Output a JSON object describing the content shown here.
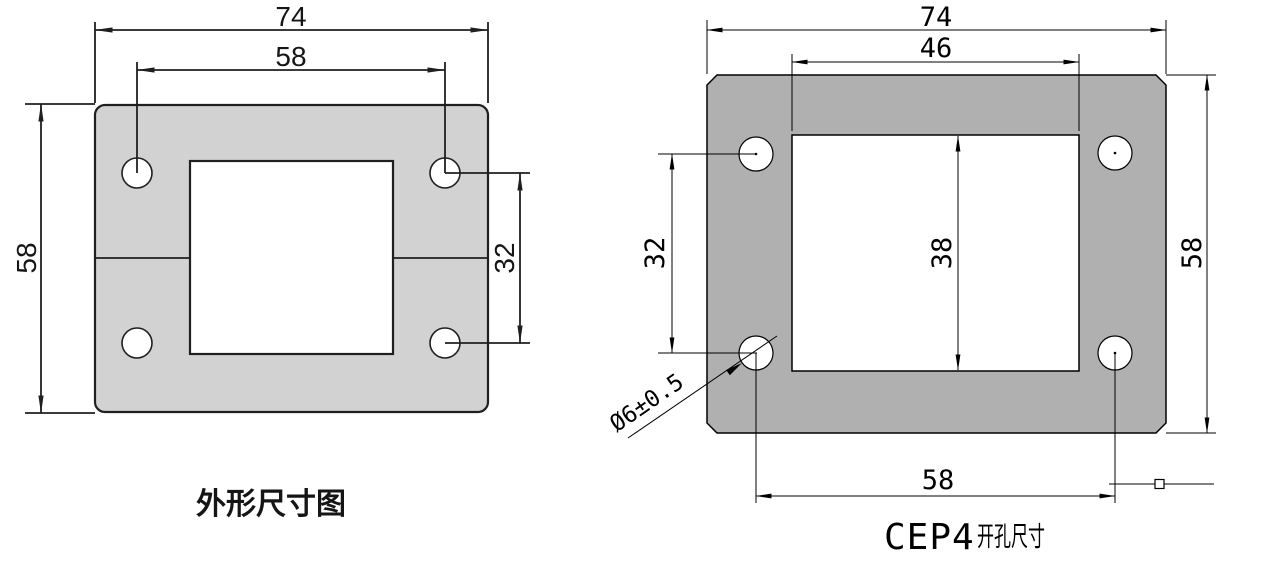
{
  "left_diagram": {
    "caption": "外形尺寸图",
    "plate_color": "#d2d2d2",
    "dimensions": {
      "overall_width": "74",
      "hole_spacing_horizontal": "58",
      "overall_height": "58",
      "hole_spacing_vertical": "32"
    }
  },
  "right_diagram": {
    "caption_model": "CEP4",
    "caption_suffix": "开孔尺寸",
    "plate_color": "#b0b0b0",
    "dimensions": {
      "overall_width": "74",
      "cutout_width": "46",
      "overall_height": "58",
      "cutout_height": "38",
      "hole_spacing_vertical": "32",
      "hole_spacing_horizontal": "58",
      "hole_diameter": "Ø6±0.5"
    }
  }
}
